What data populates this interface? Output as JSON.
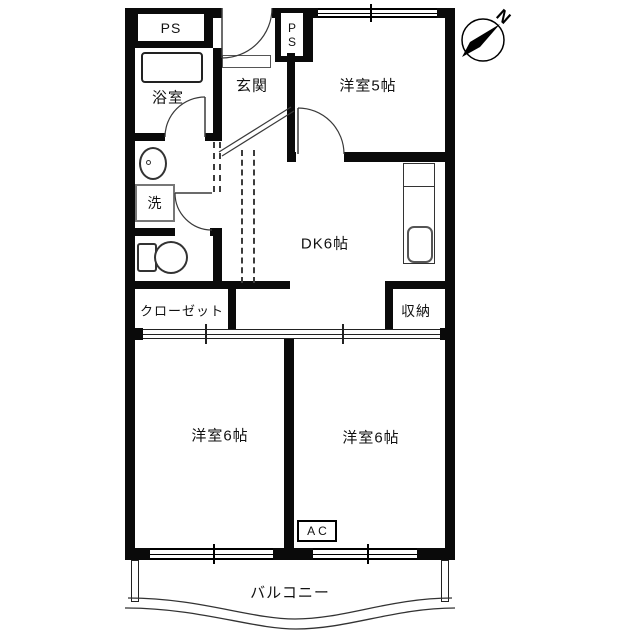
{
  "floorplan": {
    "labels": {
      "ps_top": "PS",
      "ps_shaft": "PS",
      "entrance": "玄関",
      "bathroom": "浴室",
      "western_room_5": "洋室5帖",
      "dining_kitchen": "DK6帖",
      "laundry": "洗",
      "closet": "クローゼット",
      "storage": "収納",
      "western_room_6_left": "洋室6帖",
      "western_room_6_right": "洋室6帖",
      "air_conditioner": "AC",
      "balcony": "バルコニー",
      "compass_north": "N"
    },
    "colors": {
      "wall": "#0a0a0a",
      "thin_line": "#3a3a3a",
      "background": "#ffffff"
    }
  }
}
